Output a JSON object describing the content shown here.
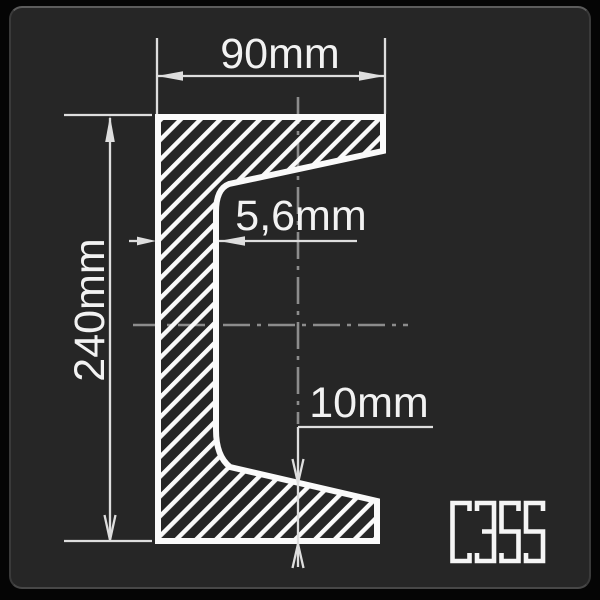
{
  "panel": {
    "background": "#262626",
    "outer_background": "#050505"
  },
  "drawing": {
    "type": "channel-steel-cross-section",
    "grade": "C355",
    "dimensions": {
      "width": "90mm",
      "height": "240mm",
      "web_thickness": "5,6mm",
      "flange_thickness": "10mm"
    },
    "colors": {
      "profile_line": "#fafafa",
      "hatch": "#fafafa",
      "dimension_line": "#dedede",
      "dimension_text": "#f2f2f2",
      "centerline": "#8c8c8c",
      "grade_text": "#f5f5f5"
    }
  }
}
